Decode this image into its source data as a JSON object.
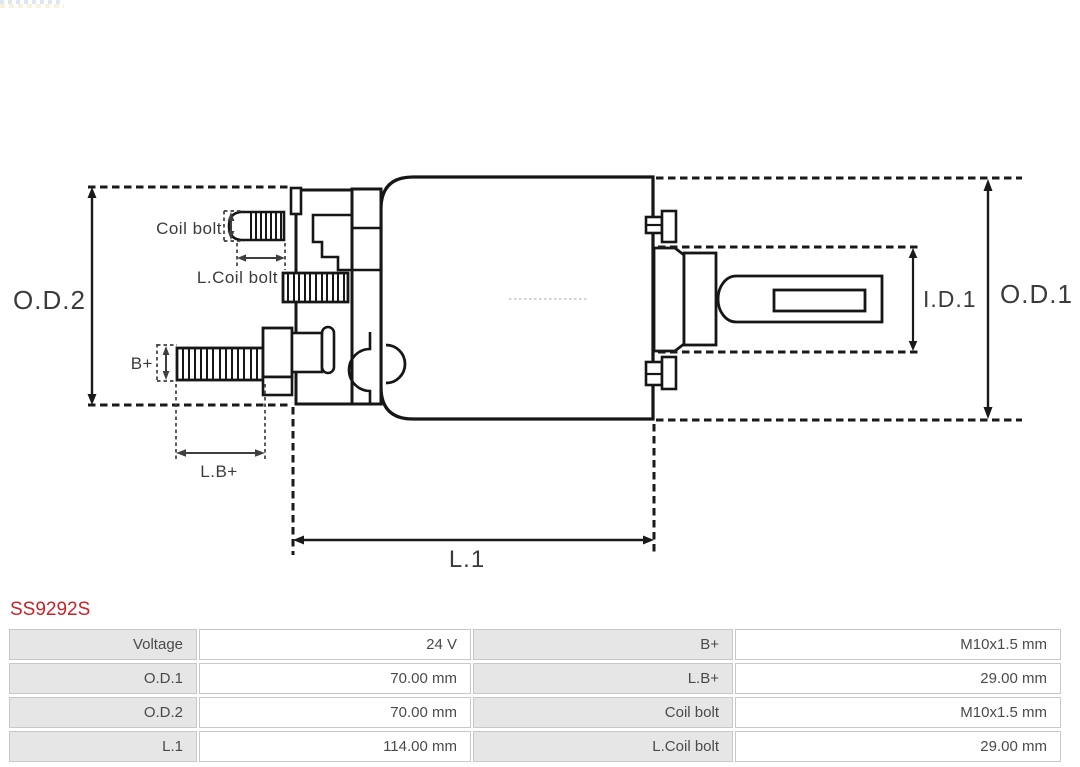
{
  "part_number": "SS9292S",
  "colors": {
    "part_number_red": "#cb2128",
    "drawing_line": "#161616",
    "dimension_arrow": "#2e2e2e",
    "table_label_bg": "#e6e6e6",
    "table_border": "#c8c8c8",
    "table_text": "#4a4a4a"
  },
  "diagram": {
    "labels": {
      "od2": "O.D.2",
      "od1": "O.D.1",
      "id1": "I.D.1",
      "l1": "L.1",
      "coil_bolt": "Coil bolt",
      "l_coil_bolt": "L.Coil bolt",
      "b_plus": "B+",
      "l_b_plus": "L.B+"
    }
  },
  "table": {
    "rows": [
      {
        "label1": "Voltage",
        "value1": "24 V",
        "label2": "B+",
        "value2": "M10x1.5 mm"
      },
      {
        "label1": "O.D.1",
        "value1": "70.00 mm",
        "label2": "L.B+",
        "value2": "29.00 mm"
      },
      {
        "label1": "O.D.2",
        "value1": "70.00 mm",
        "label2": "Coil bolt",
        "value2": "M10x1.5 mm"
      },
      {
        "label1": "L.1",
        "value1": "114.00 mm",
        "label2": "L.Coil bolt",
        "value2": "29.00 mm"
      }
    ]
  }
}
